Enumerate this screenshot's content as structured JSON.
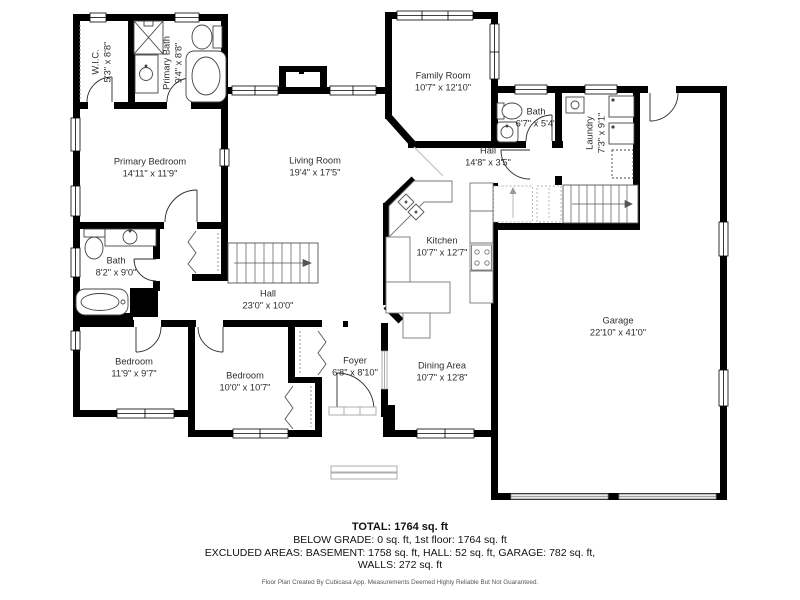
{
  "rooms": [
    {
      "name": "W.I.C.",
      "dims": "5'3\" x 8'8\""
    },
    {
      "name": "Primary Bath",
      "dims": "9'4\" x 8'8\""
    },
    {
      "name": "Primary Bedroom",
      "dims": "14'11\" x 11'9\""
    },
    {
      "name": "Living Room",
      "dims": "19'4\" x 17'5\""
    },
    {
      "name": "Family Room",
      "dims": "10'7\" x 12'10\""
    },
    {
      "name": "Bath",
      "dims": "6'7\" x 5'4\""
    },
    {
      "name": "Hall",
      "dims": "14'8\" x 3'5\""
    },
    {
      "name": "Laundry",
      "dims": "7'3\" x 9'1\""
    },
    {
      "name": "Kitchen",
      "dims": "10'7\" x 12'7\""
    },
    {
      "name": "Hall",
      "dims": "23'0\" x 10'0\""
    },
    {
      "name": "Bath",
      "dims": "8'2\" x 9'0\""
    },
    {
      "name": "Bedroom",
      "dims": "11'9\" x 9'7\""
    },
    {
      "name": "Bedroom",
      "dims": "10'0\" x 10'7\""
    },
    {
      "name": "Foyer",
      "dims": "6'8\" x 8'10\""
    },
    {
      "name": "Dining Area",
      "dims": "10'7\" x 12'8\""
    },
    {
      "name": "Garage",
      "dims": "22'10\" x 41'0\""
    }
  ],
  "footer": {
    "total": "TOTAL: 1764 sq. ft",
    "below_grade": "BELOW GRADE: 0 sq. ft, 1st floor: 1764 sq. ft",
    "excluded_areas": "EXCLUDED AREAS: BASEMENT: 1758 sq. ft, HALL: 52 sq. ft, GARAGE: 782 sq. ft,",
    "walls": "WALLS: 272 sq. ft",
    "disclaimer": "Floor Plan Created By Cubicasa App. Measurements Deemed Highly Reliable But Not Guaranteed."
  },
  "colors": {
    "wall": "#000000",
    "fixture_stroke": "#444444",
    "stair_stroke": "#666666",
    "text": "#2d2d2d"
  }
}
